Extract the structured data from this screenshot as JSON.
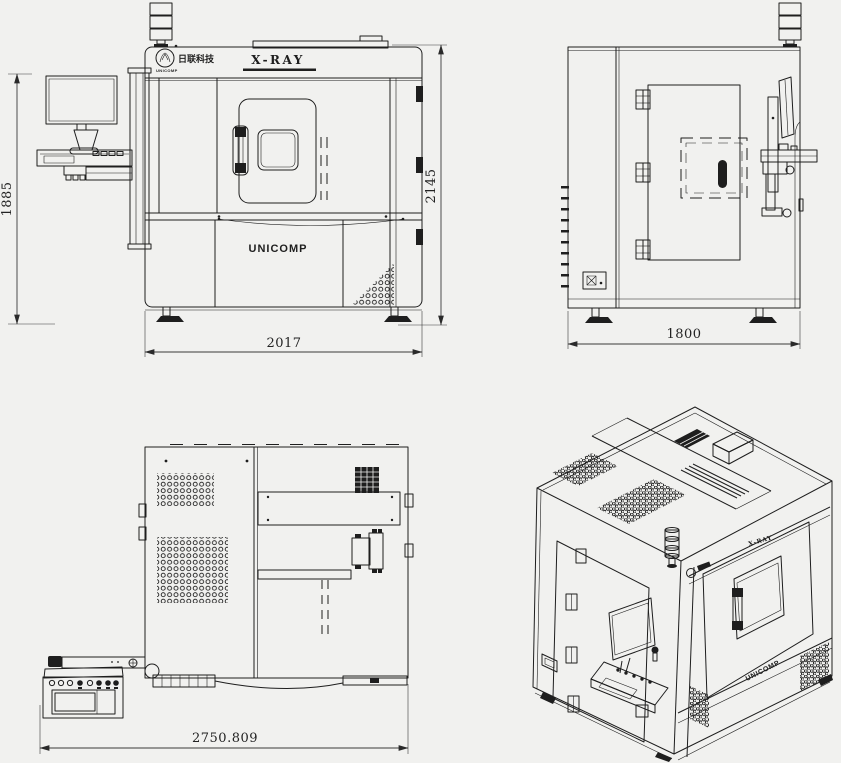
{
  "labels": {
    "xray": "X-RAY",
    "brand": "UNICOMP",
    "logo_cjk": "日联科技",
    "logo_sub": "UNICOMP"
  },
  "dimensions": {
    "front_height_left": "1885",
    "front_height_right": "2145",
    "front_width": "2017",
    "side_width": "1800",
    "rear_width": "2750.809"
  },
  "colors": {
    "background": "#f1f1ef",
    "line": "#1e1e1e",
    "dim_text": "#232323"
  }
}
